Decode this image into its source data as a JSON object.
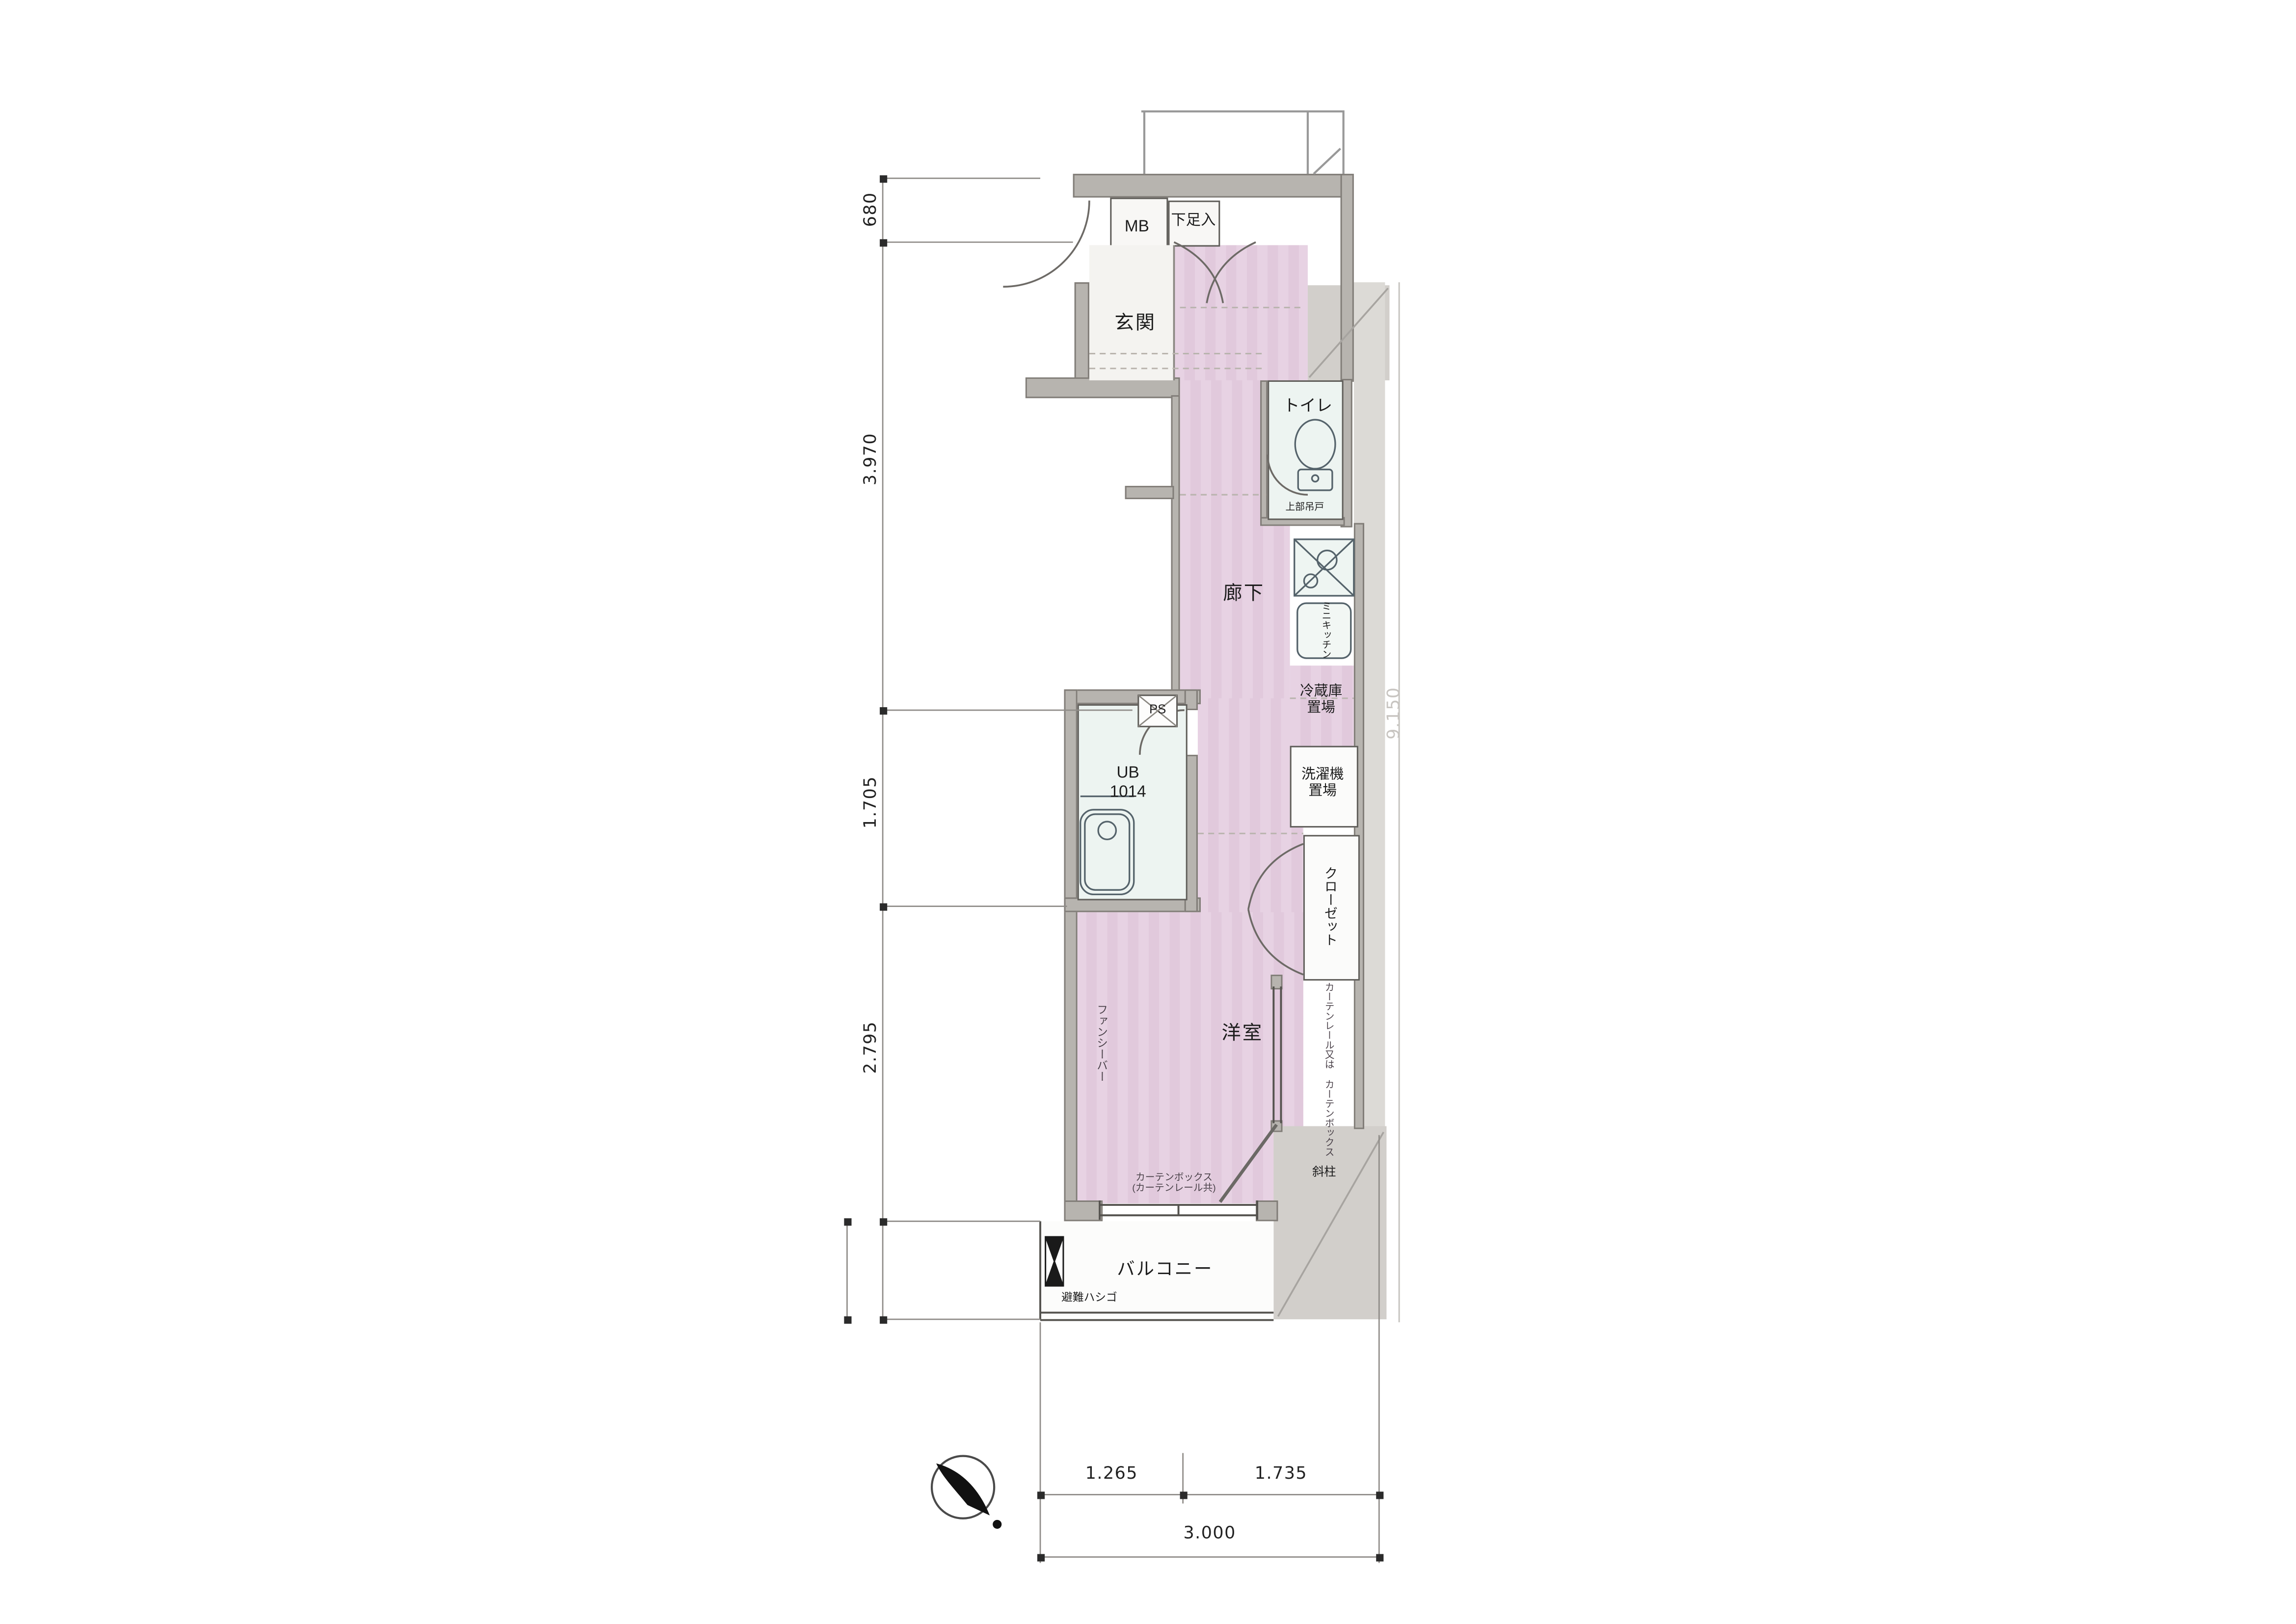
{
  "meta": {
    "type": "japanese-apartment-floor-plan"
  },
  "rooms": {
    "meter_box": "MB",
    "shoe_cabinet": "下足入",
    "entrance": "玄関",
    "corridor": "廊下",
    "toilet": "トイレ",
    "toilet_upper_cabinet_note": "上部吊戸",
    "kitchen_unit": "ミニキッチン",
    "fridge_space_l1": "冷蔵庫",
    "fridge_space_l2": "置場",
    "pipe_shaft": "PS",
    "unit_bath_l1": "UB",
    "unit_bath_l2": "1014",
    "washer_space_l1": "洗濯機",
    "washer_space_l2": "置場",
    "closet": "クローゼット",
    "western_room": "洋室",
    "fancy_bar_note": "ファンシーバー",
    "curtain_note_v1": "カーテンレール又は",
    "curtain_note_v2": "カーテンボックス",
    "curtain_note_h1": "カーテンボックス",
    "curtain_note_h2": "(カーテンレール共)",
    "slanted_pillar": "斜柱",
    "balcony": "バルコニー",
    "escape_ladder": "避難ハシゴ"
  },
  "dimensions": {
    "left": [
      {
        "value": "680"
      },
      {
        "value": "3.970"
      },
      {
        "value": "1.705"
      },
      {
        "value": "2.795"
      }
    ],
    "right_total": "9.150",
    "bottom": [
      {
        "value": "1.265"
      },
      {
        "value": "1.735"
      }
    ],
    "bottom_total": "3.000"
  },
  "colors": {
    "floor_pink": "#e5cee1",
    "wall_gray": "#b7b4af",
    "wet_area": "#ecf4f1",
    "hatch_gray": "#d2cfcb"
  }
}
